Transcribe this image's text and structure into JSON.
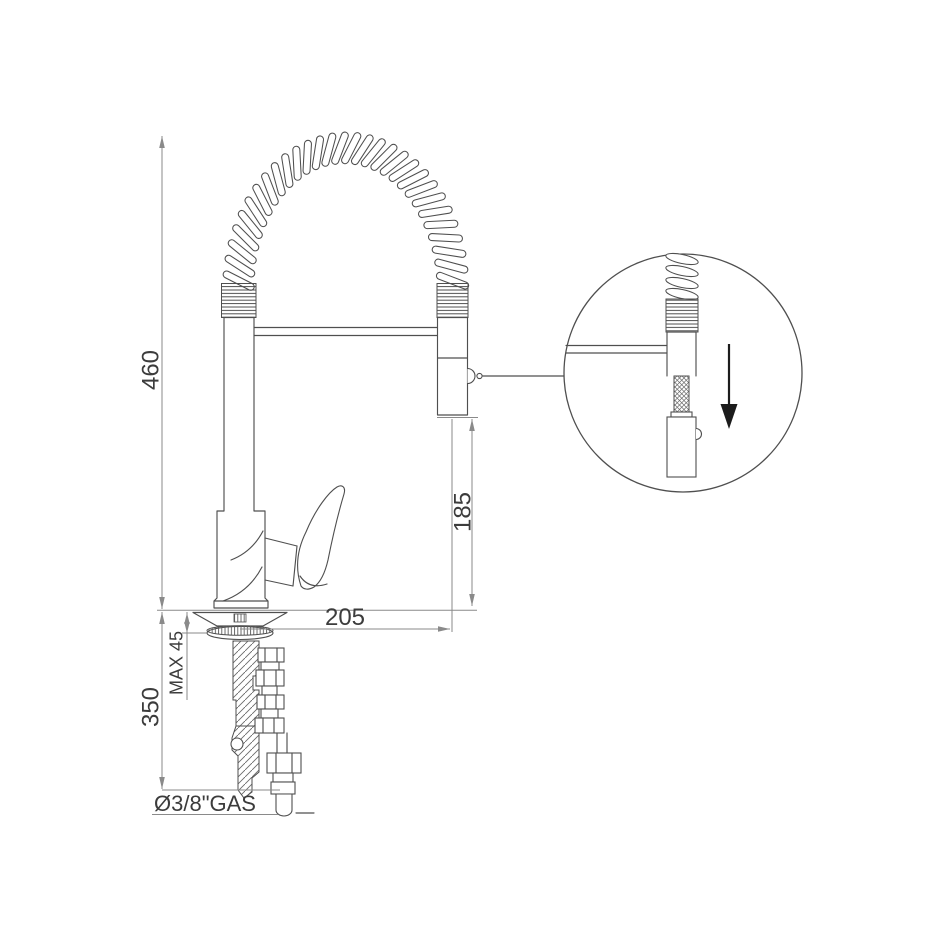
{
  "page": {
    "background": "#ffffff"
  },
  "drawing": {
    "type": "technical dimension drawing",
    "subject": "single-lever kitchen mixer tap with spring pull-down spout",
    "colors": {
      "outline": "#4f4f4f",
      "dimension_lines": "#8a8a8a",
      "text": "#3c3c3c",
      "detail_arrow": "#1c1c1c",
      "background": "#ffffff"
    },
    "dimensions": {
      "total_height": {
        "value": "460"
      },
      "spout_clearance": {
        "value": "185"
      },
      "spout_reach": {
        "value": "205"
      },
      "max_deck_thickness": {
        "value": "MAX 45"
      },
      "under_counter_depth": {
        "value": "350"
      },
      "supply_connection": {
        "value": "Ø3/8\"GAS"
      }
    },
    "detail_view": {
      "content": "pull-out spray head on hose below spring spout",
      "arrow_direction": "down"
    }
  }
}
